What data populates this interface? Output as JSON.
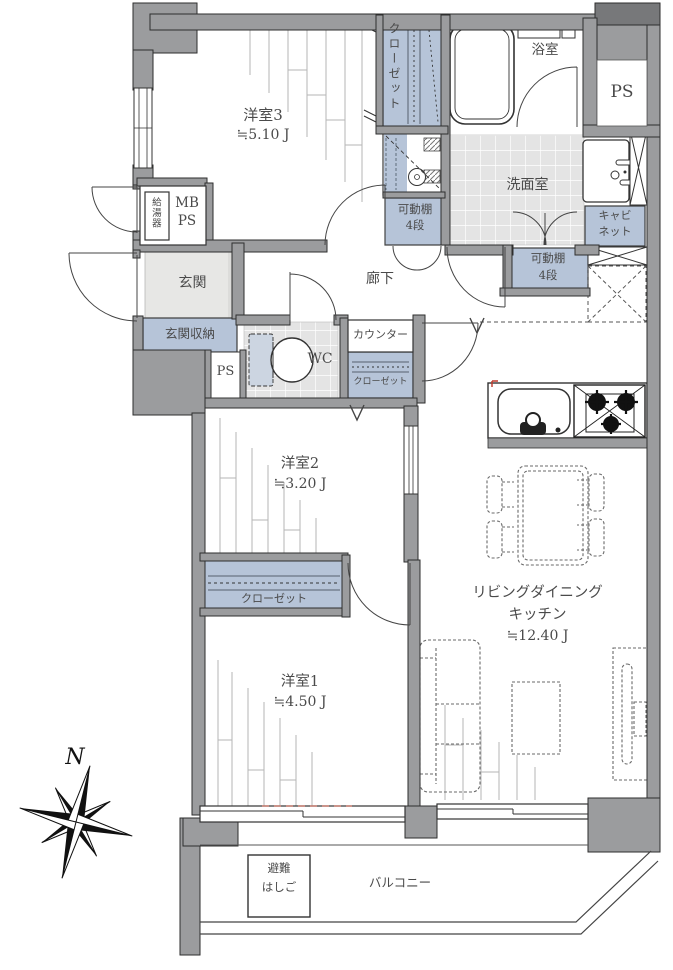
{
  "rooms": {
    "bedroom3": {
      "name": "洋室3",
      "size": "≒5.10 J"
    },
    "bedroom2": {
      "name": "洋室2",
      "size": "≒3.20 J"
    },
    "bedroom1": {
      "name": "洋室1",
      "size": "≒4.50 J"
    },
    "ldk": {
      "name_line1": "リビングダイニング",
      "name_line2": "キッチン",
      "size": "≒12.40 J"
    },
    "hallway": {
      "name": "廊下"
    },
    "entrance": {
      "name": "玄関"
    },
    "entrance_storage": {
      "name": "玄関収納"
    },
    "washroom": {
      "name": "洗面室"
    },
    "bathroom": {
      "name": "浴室"
    },
    "toilet": {
      "name": "WC"
    },
    "balcony": {
      "name": "バルコニー"
    }
  },
  "fixtures": {
    "closet": "クローゼット",
    "movable_shelf": {
      "line1": "可動棚",
      "line2": "4段"
    },
    "cabinet": {
      "line1": "キャビ",
      "line2": "ネット"
    },
    "counter": "カウンター",
    "pipe_space": "PS",
    "meter_box": {
      "line1": "MB",
      "line2": "PS"
    },
    "water_heater": "給湯器",
    "escape_ladder": {
      "line1": "避難",
      "line2": "はしご"
    }
  },
  "compass": {
    "north": "N"
  },
  "colors": {
    "wall": "#9b9c9e",
    "dark_wall": "#77787a",
    "fixture_blue": "#b6c4d8",
    "tile": "#e4e4e4",
    "accent_red": "#c87f72"
  }
}
